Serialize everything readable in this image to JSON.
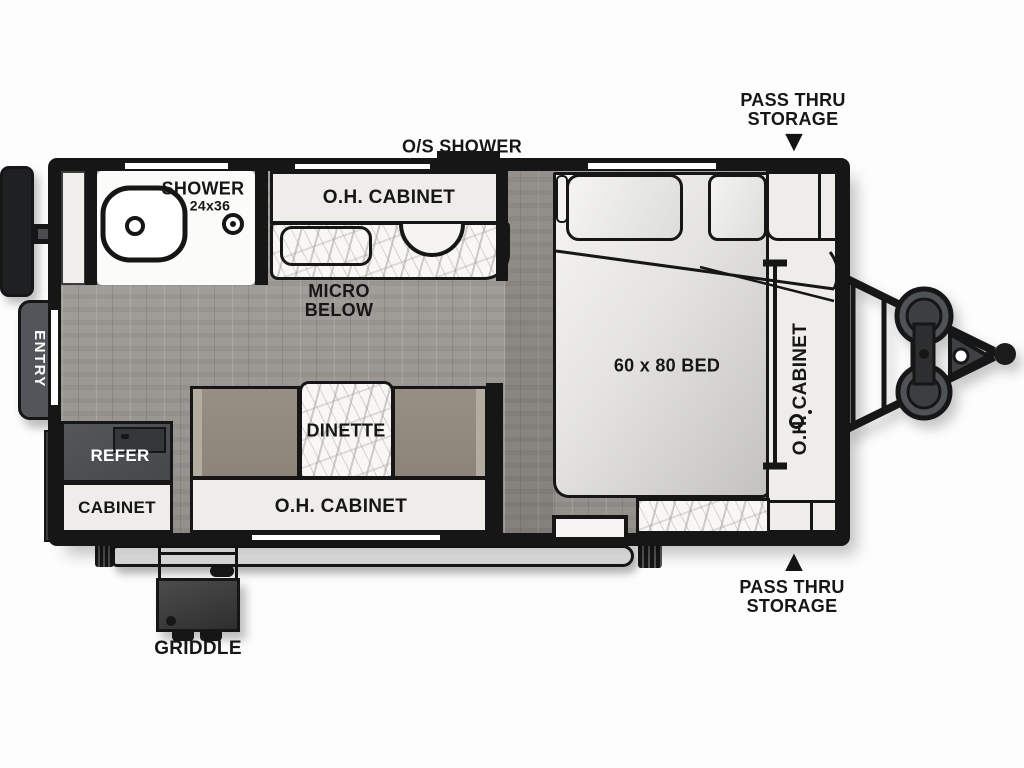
{
  "labels": {
    "pass_thru_top": {
      "line1": "PASS THRU",
      "line2": "STORAGE"
    },
    "pass_thru_bottom": {
      "line1": "PASS THRU",
      "line2": "STORAGE"
    },
    "os_shower": "O/S SHOWER",
    "shower": "SHOWER",
    "shower_size": "24x36",
    "kitchen_oh_cabinet": "O.H. CABINET",
    "micro": {
      "line1": "MICRO",
      "line2": "BELOW"
    },
    "entry": "ENTRY",
    "refer": "REFER",
    "cabinet": "CABINET",
    "dinette": "DINETTE",
    "bottom_oh_cabinet": "O.H. CABINET",
    "bed": "60 x 80 BED",
    "right_oh_cabinet": "O.H. CABINET",
    "griddle": "GRIDDLE"
  },
  "icons": {
    "arrow_down": "▼",
    "arrow_up": "▲"
  },
  "colors": {
    "wall": "#161616",
    "floor": "#a09c97",
    "cabinet": "#efede9",
    "marble_base": "#f8f7f5",
    "bench": "#8d8478",
    "appliance_dark": "#45484a",
    "entry_step": "#53555a",
    "bed_dark": "#c3c2c0",
    "tank": "#505356",
    "tire": "#1f2022"
  }
}
